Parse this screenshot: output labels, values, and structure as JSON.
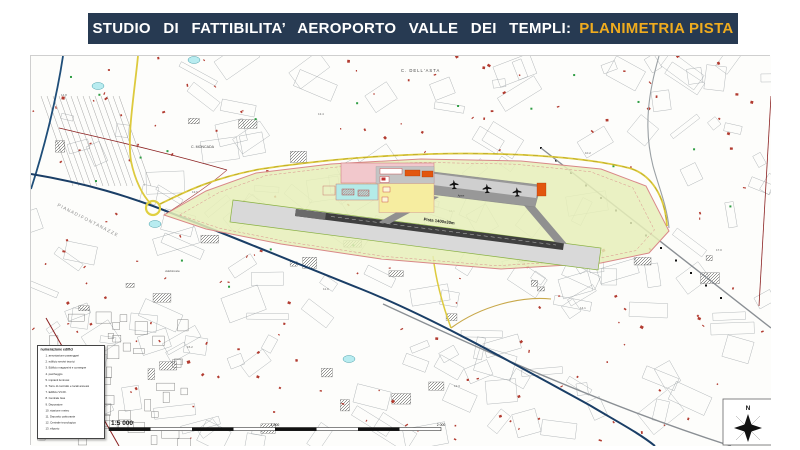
{
  "title": {
    "main": "STUDIO DI FATTIBILITA’ AEROPORTO VALLE DEI TEMPLI:",
    "highlight": "PLANIMETRIA PISTA"
  },
  "colors": {
    "title_bar_bg": "#273a52",
    "title_highlight": "#f0ac1e",
    "airport_area_fill": "#e6efb8",
    "airport_boundary": "#d98888",
    "runway_dark": "#3f3f3f",
    "strip_gray": "#d9d9d9",
    "apron_gray": "#989898",
    "terminal_pink": "#f2c8cc",
    "building_orange": "#e2560e",
    "zone_yellow": "#f6eda0",
    "zone_cyan": "#b4ebe8",
    "road_blue": "#1a3e66",
    "road_yellow": "#ddca3e",
    "river_blue": "#1f4e79",
    "road_maroon": "#8b2020"
  },
  "map": {
    "labels": {
      "locality_1": "C. DELL'ASTA",
      "locality_2": "C. MONCADA",
      "plain": "P I A N A   D I   F O N T A N A Z Z E",
      "locality_3": "Addolorata",
      "runway": "Pista 1400x30m",
      "apron": "Apron"
    },
    "spot_heights": [
      "14.8",
      "13.6",
      "11.9",
      "12.3",
      "10.2",
      "17.0",
      "15.2",
      "13.4",
      "16.1",
      "14.1"
    ],
    "scale": {
      "ratio": "1:5 000",
      "mid_label": "1 000",
      "end_label": "2 000"
    },
    "compass": {
      "north": "N"
    }
  },
  "legend": {
    "title": "numerazione edifici",
    "items": [
      "1. aerostazione passeggeri",
      "2. edificio servizi tecnici",
      "3. Edificio magazzini e consegne",
      "4. parcheggio",
      "5. impianti luminosi",
      "6. Torre di controllo e locali annessi",
      "7. Edificio VV.FF.",
      "8. Centrale Gas",
      "9. Depuratore",
      "10. stazione meteo",
      "11. Deposito carburante",
      "12. Centrale tecnologica",
      "13. eliporto"
    ]
  }
}
